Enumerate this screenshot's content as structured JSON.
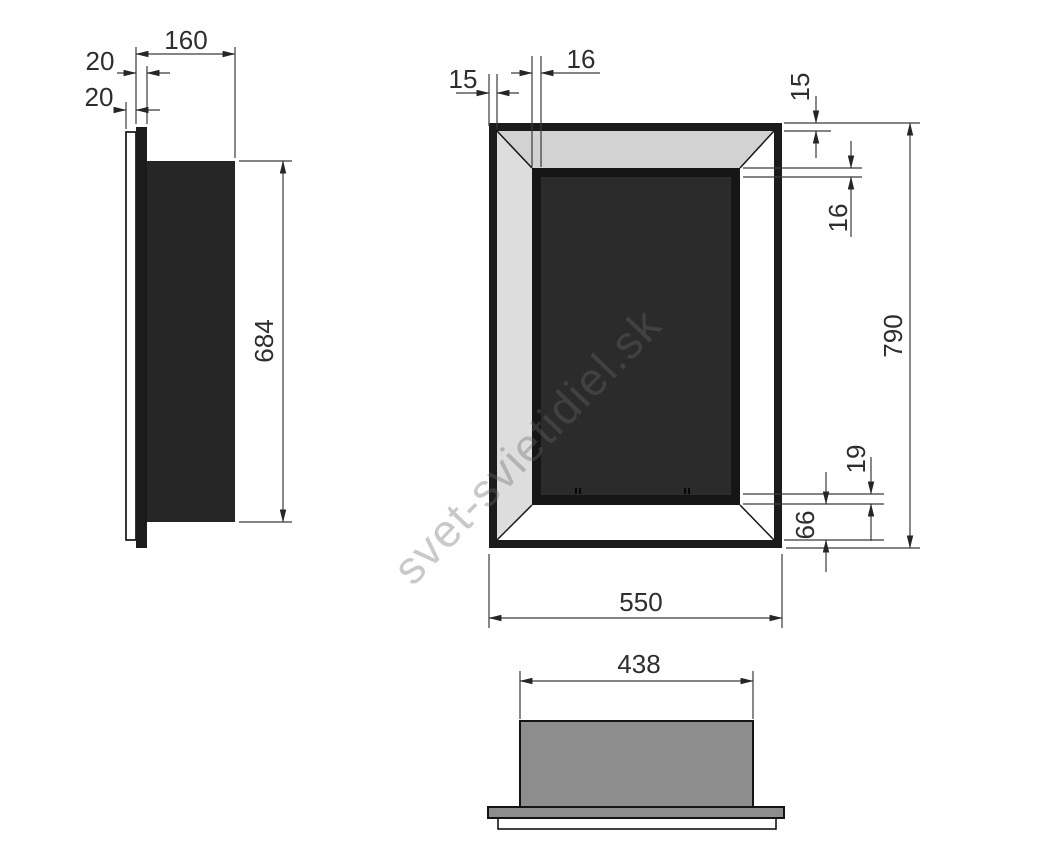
{
  "drawing": {
    "title_hint": "built-in fireplace dimension drawing",
    "watermark": "svet-svietidiel.sk",
    "side_view": {
      "depth": "160",
      "front_plate": "20",
      "wall_plate": "20",
      "height": "684"
    },
    "front_view": {
      "frame_left": "15",
      "lip_top": "16",
      "frame_top": "15",
      "lip_right": "16",
      "lip_bottom": "19",
      "bottom_inset": "66",
      "height": "790",
      "width": "550"
    },
    "bottom_view": {
      "width": "438"
    },
    "colors": {
      "outline": "#1b1b1b",
      "body_fill": "#262626",
      "firebox_fill": "#2b2b2b",
      "bevel_gray": "#d2d2d2",
      "bevel_gray_left": "#dddddd",
      "mid_gray": "#8d8d8d",
      "dimension_text": "#2e2e2e",
      "watermark_gray": "#696969"
    }
  }
}
